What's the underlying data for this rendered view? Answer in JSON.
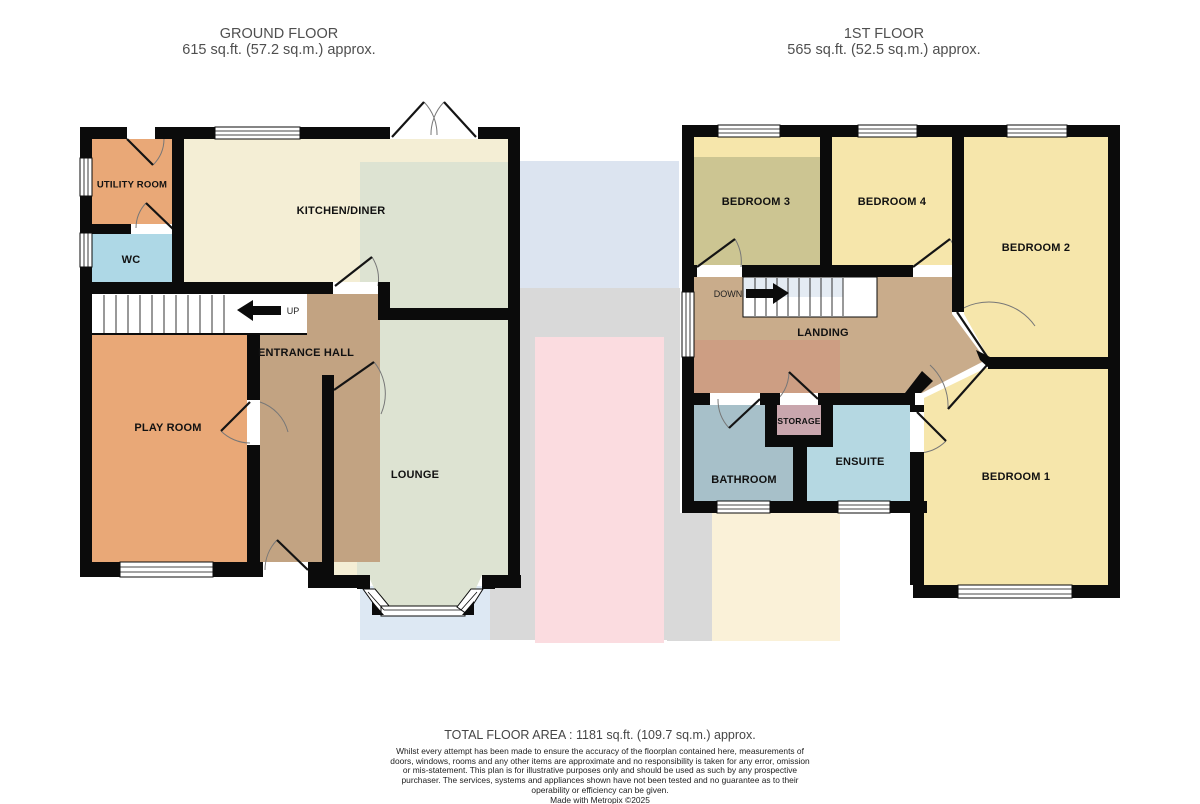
{
  "ground_floor": {
    "title": "GROUND FLOOR",
    "area": "615 sq.ft. (57.2 sq.m.) approx.",
    "stairs_label": "UP",
    "rooms": {
      "utility": "UTILITY ROOM",
      "wc": "WC",
      "kitchen": "KITCHEN/DINER",
      "hall": "ENTRANCE HALL",
      "playroom": "PLAY ROOM",
      "lounge": "LOUNGE"
    }
  },
  "first_floor": {
    "title": "1ST FLOOR",
    "area": "565 sq.ft. (52.5 sq.m.) approx.",
    "stairs_label": "DOWN",
    "rooms": {
      "bedroom3": "BEDROOM 3",
      "bedroom4": "BEDROOM 4",
      "bedroom2": "BEDROOM 2",
      "bedroom1": "BEDROOM 1",
      "landing": "LANDING",
      "storage": "STORAGE",
      "bathroom": "BATHROOM",
      "ensuite": "ENSUITE"
    }
  },
  "footer": {
    "total_area": "TOTAL FLOOR AREA : 1181 sq.ft. (109.7 sq.m.) approx.",
    "disclaimer": "Whilst every attempt has been made to ensure the accuracy of the floorplan contained here, measurements of doors, windows, rooms and any other items are approximate and no responsibility is taken for any error, omission or mis-statement. This plan is for illustrative purposes only and should be used as such by any prospective purchaser. The services, systems and appliances shown have not been tested and no guarantee as to their operability or efficiency can be given.",
    "credit": "Made with Metropix ©2025"
  },
  "colors": {
    "wall": "#0b0b0b",
    "room_orange": "#e9a877",
    "room_blue": "#aed8e6",
    "room_cream": "#f4eed5",
    "room_sage": "#dde3d2",
    "room_tan": "#c2a382",
    "room_landing": "#c9ac8b",
    "overlay_salmon": "#cd9a80",
    "room_yellow": "#f6e6ab",
    "room_olive": "#ccc592",
    "room_bath": "#a7c0c9",
    "room_ensuite": "#b5d8e2",
    "room_storage": "#c9a6ad",
    "stair_tint": "#dfe8f1",
    "bg_blue": "#dce4f0",
    "bg_grey": "#d9d9d9",
    "bg_pink": "#fbdce0",
    "bg_cream": "#faf1d8",
    "bg_bay_blue": "#dde8f3"
  }
}
